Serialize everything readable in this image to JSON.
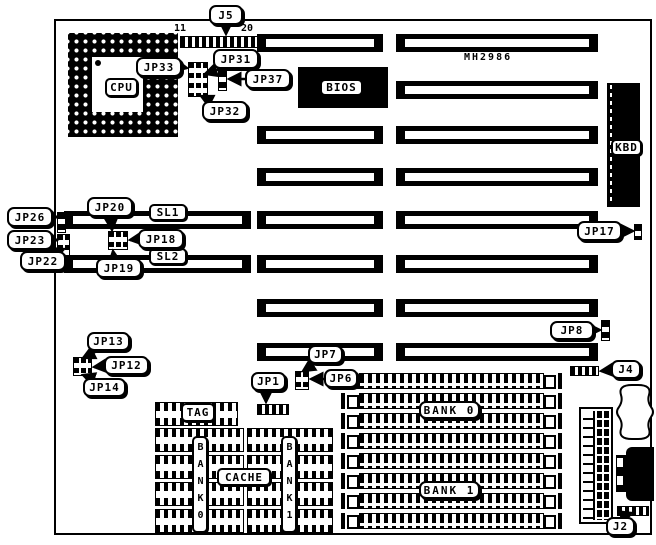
{
  "board": {
    "model": "MH2986"
  },
  "labels": {
    "j5": "J5",
    "jp33": "JP33",
    "jp31": "JP31",
    "jp37": "JP37",
    "jp32": "JP32",
    "cpu": "CPU",
    "bios": "BIOS",
    "kbd": "KBD",
    "jp17": "JP17",
    "jp26": "JP26",
    "jp23": "JP23",
    "jp22": "JP22",
    "jp20": "JP20",
    "sl1": "SL1",
    "jp18": "JP18",
    "jp19": "JP19",
    "sl2": "SL2",
    "jp13": "JP13",
    "jp12": "JP12",
    "jp14": "JP14",
    "jp8": "JP8",
    "jp7": "JP7",
    "jp1": "JP1",
    "jp6": "JP6",
    "j4": "J4",
    "j2": "J2",
    "tag": "TAG",
    "cache": "CACHE",
    "cache_bank0": "BANK0",
    "cache_bank1": "BANK1",
    "simm_bank0": "BANK 0",
    "simm_bank1": "BANK 1"
  },
  "pin_numbers": {
    "j5_first": "11",
    "j5_last": "20"
  },
  "colors": {
    "ink": "#000000",
    "paper": "#ffffff"
  }
}
